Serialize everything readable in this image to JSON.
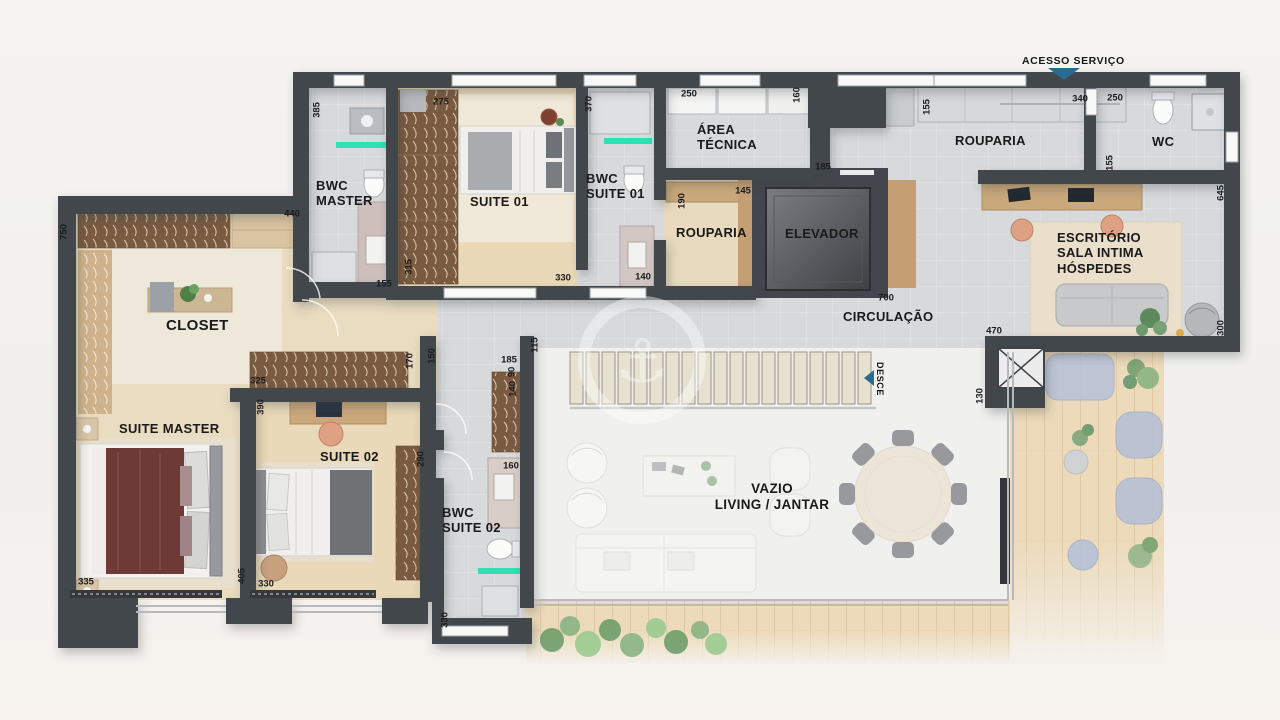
{
  "plan": {
    "service_access_label": "ACESSO SERVIÇO",
    "stairs_label": "DESCE",
    "watermark_icon": "⚓",
    "rooms": [
      {
        "id": "bwc-master",
        "label": "BWC\nMASTER"
      },
      {
        "id": "suite-01",
        "label": "SUITE 01"
      },
      {
        "id": "bwc-suite-01",
        "label": "BWC\nSUITE 01"
      },
      {
        "id": "area-tecnica",
        "label": "ÁREA\nTÉCNICA"
      },
      {
        "id": "rouparia-left",
        "label": "ROUPARIA"
      },
      {
        "id": "elevador",
        "label": "ELEVADOR"
      },
      {
        "id": "rouparia-right",
        "label": "ROUPARIA"
      },
      {
        "id": "wc",
        "label": "WC"
      },
      {
        "id": "escritorio",
        "label": "ESCRITÓRIO\nSALA INTIMA\nHÓSPEDES"
      },
      {
        "id": "circulacao",
        "label": "CIRCULAÇÃO"
      },
      {
        "id": "closet",
        "label": "CLOSET"
      },
      {
        "id": "suite-master",
        "label": "SUITE MASTER"
      },
      {
        "id": "suite-02",
        "label": "SUITE 02"
      },
      {
        "id": "bwc-suite-02",
        "label": "BWC\nSUITE 02"
      },
      {
        "id": "vazio-living",
        "label": "VAZIO\nLIVING / JANTAR"
      }
    ],
    "dimensions": [
      "385",
      "275",
      "370",
      "250",
      "160",
      "155",
      "340",
      "250",
      "155",
      "645",
      "440",
      "155",
      "315",
      "330",
      "140",
      "185",
      "145",
      "190",
      "700",
      "470",
      "130",
      "300",
      "750",
      "325",
      "390",
      "170",
      "150",
      "185",
      "115",
      "90",
      "140",
      "290",
      "160",
      "330",
      "335",
      "405",
      "330"
    ],
    "colors": {
      "wall": "#43464c",
      "teal_accent": "#2fe0b4",
      "arrow_blue": "#2a6b94",
      "tile_floor": "#d8d9db",
      "wood_floor": "#e9dcc0",
      "wardrobe_wood": "#7a5a41",
      "deck_wood": "#ecdaba",
      "ghost_blue": "#b7c3da",
      "watermark_white": "#ffffff"
    }
  }
}
